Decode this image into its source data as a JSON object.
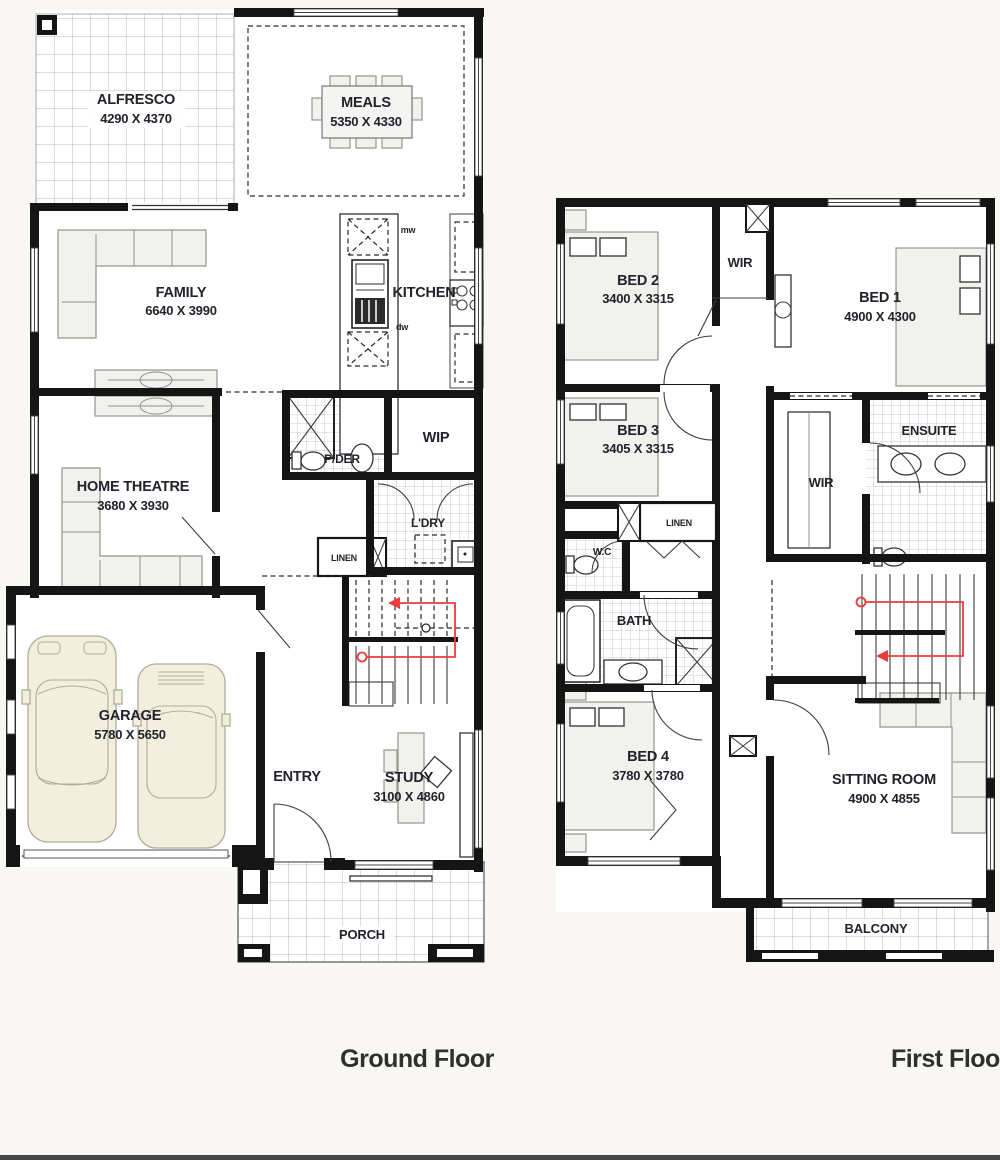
{
  "colors": {
    "background": "#f8f7f4",
    "wall": "#151515",
    "label_text": "#22222c",
    "stair_path_red": "#ee3b3b",
    "tile_grid": "#b8b8b8",
    "furniture_fill": "#f1f1ee",
    "car_fill": "#f2efdc",
    "title_text": "#2f2f2f",
    "footer_bar": "#474747"
  },
  "ground_floor": {
    "title": "Ground Floor",
    "rooms": {
      "alfresco": {
        "name": "ALFRESCO",
        "dims": "4290 X 4370"
      },
      "meals": {
        "name": "MEALS",
        "dims": "5350 X 4330"
      },
      "family": {
        "name": "FAMILY",
        "dims": "6640 X 3990"
      },
      "kitchen": {
        "name": "KITCHEN"
      },
      "wip": {
        "name": "WIP"
      },
      "pder": {
        "name": "P/DER"
      },
      "home_theatre": {
        "name": "HOME THEATRE",
        "dims": "3680 X 3930"
      },
      "ldry": {
        "name": "L'DRY"
      },
      "linen": {
        "name": "LINEN"
      },
      "garage": {
        "name": "GARAGE",
        "dims": "5780 X 5650"
      },
      "entry": {
        "name": "ENTRY"
      },
      "study": {
        "name": "STUDY",
        "dims": "3100 X 4860"
      },
      "porch": {
        "name": "PORCH"
      }
    },
    "appliances": {
      "microwave": "mw",
      "dishwasher": "dw"
    }
  },
  "first_floor": {
    "title": "First Floor",
    "rooms": {
      "bed2": {
        "name": "BED 2",
        "dims": "3400 X 3315"
      },
      "wir_front": {
        "name": "WIR"
      },
      "bed1": {
        "name": "BED 1",
        "dims": "4900 X 4300"
      },
      "bed3": {
        "name": "BED 3",
        "dims": "3405 X 3315"
      },
      "linen": {
        "name": "LINEN"
      },
      "wc": {
        "name": "W.C"
      },
      "wir_main": {
        "name": "WIR"
      },
      "ensuite": {
        "name": "ENSUITE"
      },
      "bath": {
        "name": "BATH"
      },
      "bed4": {
        "name": "BED 4",
        "dims": "3780 X 3780"
      },
      "sitting": {
        "name": "SITTING ROOM",
        "dims": "4900 X 4855"
      },
      "balcony": {
        "name": "BALCONY"
      }
    }
  }
}
